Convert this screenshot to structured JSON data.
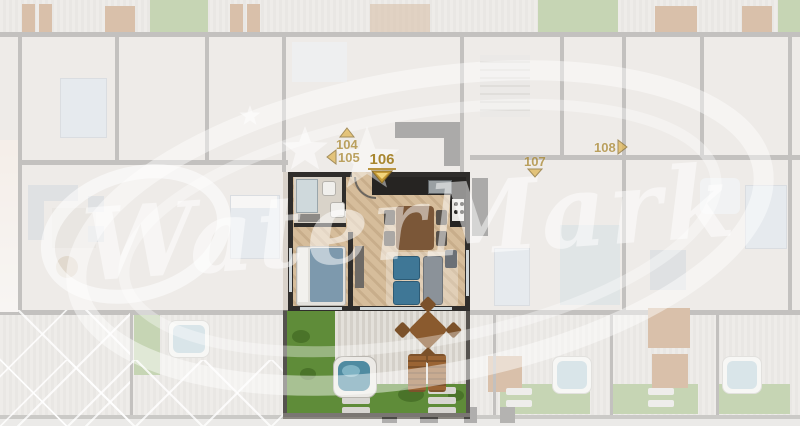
{
  "viewer": {
    "type": "residential-floorplan",
    "selected_unit": "106"
  },
  "watermark": {
    "text": "WaterMark"
  },
  "markers": [
    {
      "label": "104",
      "arrow": "up",
      "state": "default"
    },
    {
      "label": "105",
      "arrow": "left",
      "state": "default"
    },
    {
      "label": "106",
      "arrow": "down",
      "state": "selected"
    },
    {
      "label": "107",
      "arrow": "down",
      "state": "default"
    },
    {
      "label": "108",
      "arrow": "right",
      "state": "default"
    }
  ],
  "colors": {
    "marker_gold": "#a8862f",
    "arrow_fill": "#e0b654",
    "arrow_border": "#8a6d2a",
    "highlight_lawn": "#5f8c39",
    "hot_tub_water": "#4f8ba1",
    "watermark_white": "rgba(255,255,255,0.5)"
  }
}
